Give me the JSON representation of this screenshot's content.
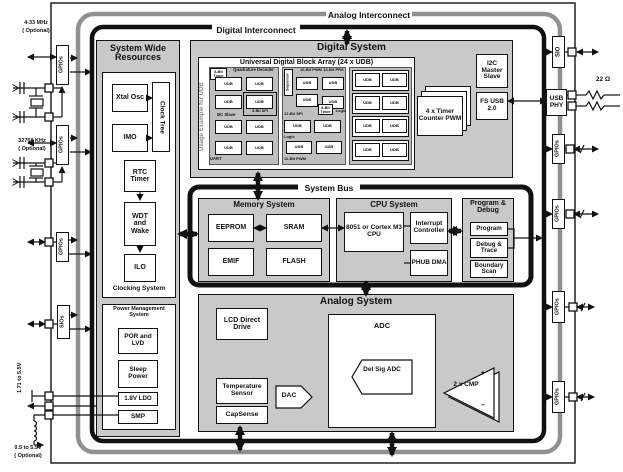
{
  "interconnect": {
    "analog": "Analog Interconnect",
    "digital": "Digital Interconnect",
    "system_bus": "System Bus"
  },
  "system_wide_resources": {
    "title": "System Wide Resources",
    "xtal_osc": "Xtal Osc",
    "clock_tree": "Clock Tree",
    "imo": "IMO",
    "rtc_timer": "RTC Timer",
    "wdt_wake": "WDT and Wake",
    "ilo": "ILO",
    "clocking_label": "Clocking System",
    "pm_title": "Power Management System",
    "por_lvd": "POR and LVD",
    "sleep_power": "Sleep Power",
    "ldo": "1.8V LDO",
    "smp": "SMP"
  },
  "digital_system": {
    "title": "Digital System",
    "udb": {
      "title": "Universal Digital Block Array (24 x UDB)",
      "side": "Usage Example for UDB",
      "cell": "UDB",
      "timer8a": "8-Bit Timer",
      "quad": "Quadrature Decoder",
      "spi8": "8-Bit SPI",
      "i2c_slave": "I2C Slave",
      "uart": "UART",
      "seq": "Sequencer",
      "pwm16": "16-Bit PWM",
      "prs16": "16-Bit PRS",
      "timer8b": "8-Bit Timer",
      "logic_a": "Logic",
      "spi12": "12-Bit SPI",
      "logic_b": "Logic",
      "pwm12": "12-Bit PWM"
    },
    "i2c": "I2C Master Slave",
    "timer_pwm": "4 x Timer Counter PWM",
    "fs_usb": "FS USB 2.0"
  },
  "memory": {
    "title": "Memory System",
    "eeprom": "EEPROM",
    "sram": "SRAM",
    "emif": "EMIF",
    "flash": "FLASH"
  },
  "cpu": {
    "title": "CPU System",
    "core": "8051 or Cortex M3 CPU",
    "interrupt": "Interrupt Controller",
    "phub": "PHUB DMA"
  },
  "debug": {
    "title": "Program & Debug",
    "program": "Program",
    "trace": "Debug & Trace",
    "boundary": "Boundary Scan"
  },
  "analog": {
    "title": "Analog System",
    "lcd": "LCD Direct Drive",
    "adc": "ADC",
    "delsig": "Del Sig ADC",
    "temp": "Temperature Sensor",
    "dac": "DAC",
    "capsense": "CapSense",
    "cmp": "2 x CMP",
    "plus": "+",
    "minus": "–"
  },
  "io": {
    "gpios": "GPIOs",
    "sios": "SIOs",
    "sio": "SIO",
    "usb_phy": "USB PHY"
  },
  "external": {
    "xtal_mhz": "4-33 MHz",
    "xtal_khz": "32768 KHz",
    "optional": "( Optional)",
    "vdd": "1.71 to 5.5V",
    "vbat": "0.5 to 5.5V",
    "r22": "22 Ω"
  },
  "colors": {
    "panel": "#c9c9c9",
    "group": "#bfbfbf",
    "frame_gray": "#909090",
    "black": "#111111"
  }
}
